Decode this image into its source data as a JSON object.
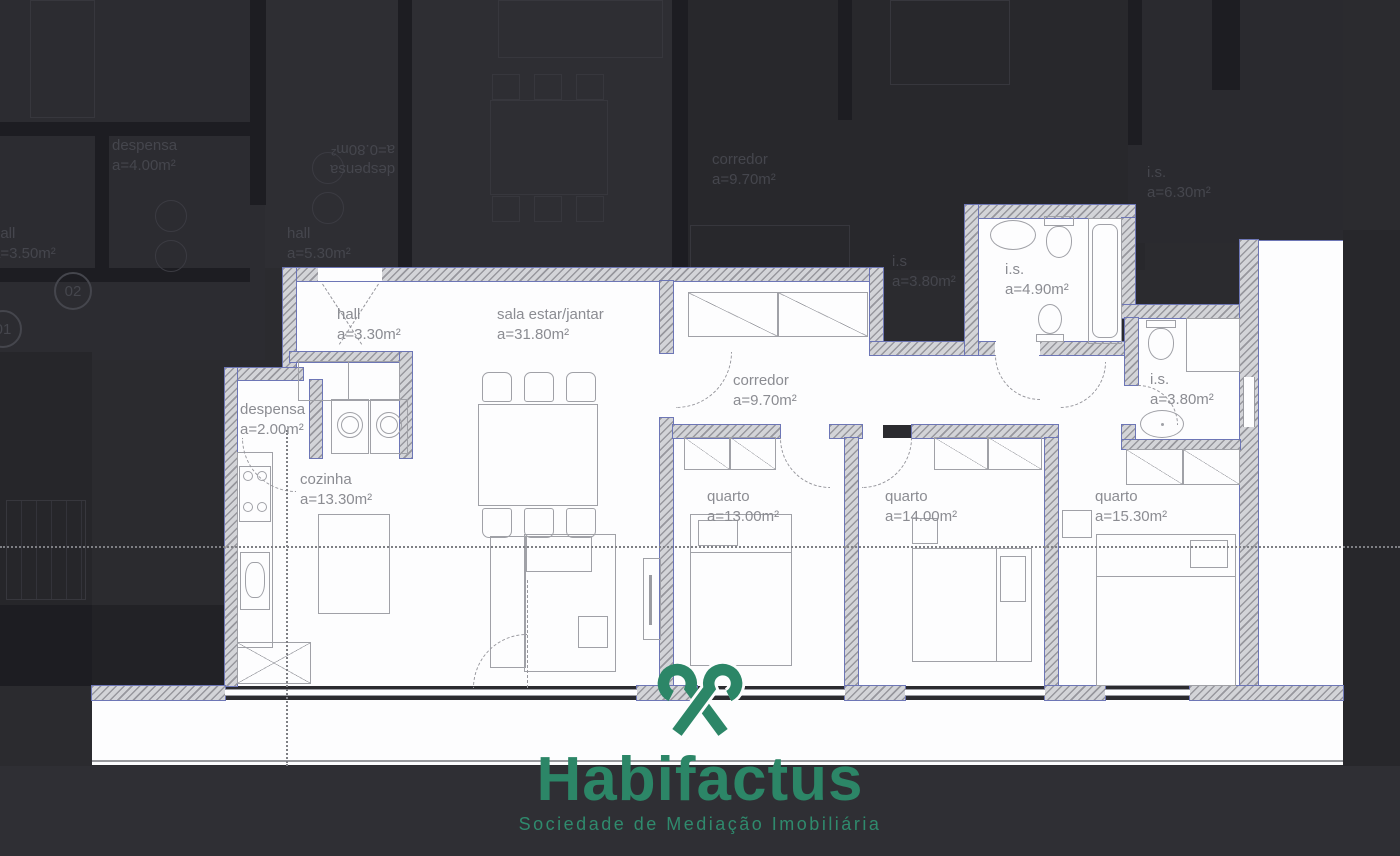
{
  "plan": {
    "rooms": [
      {
        "name": "hall",
        "area": "a=3.30m²"
      },
      {
        "name": "sala estar/jantar",
        "area": "a=31.80m²"
      },
      {
        "name": "corredor",
        "area": "a=9.70m²"
      },
      {
        "name": "despensa",
        "area": "a=2.00m²"
      },
      {
        "name": "cozinha",
        "area": "a=13.30m²"
      },
      {
        "name": "quarto",
        "area": "a=13.00m²"
      },
      {
        "name": "quarto",
        "area": "a=14.00m²"
      },
      {
        "name": "quarto",
        "area": "a=15.30m²"
      },
      {
        "name": "i.s.",
        "area": "a=4.90m²"
      },
      {
        "name": "i.s.",
        "area": "a=3.80m²"
      }
    ],
    "background_labels": [
      {
        "name": "despensa",
        "area": "a=4.00m²"
      },
      {
        "name": "hall",
        "area": "a=3.50m²"
      },
      {
        "name": "hall",
        "area": "a=5.30m²"
      },
      {
        "name": "despensa",
        "area": "a=0.80m²"
      },
      {
        "name": "corredor",
        "area": "a=9.70m²"
      },
      {
        "name": "i.s",
        "area": "a=3.80m²"
      },
      {
        "name": "i.s.",
        "area": "a=6.30m²"
      }
    ],
    "markers": [
      "02",
      "01"
    ]
  },
  "logo": {
    "brand": "Habifactus",
    "tagline": "Sociedade de Mediação Imobiliária",
    "accent_color": "#2c8667"
  }
}
